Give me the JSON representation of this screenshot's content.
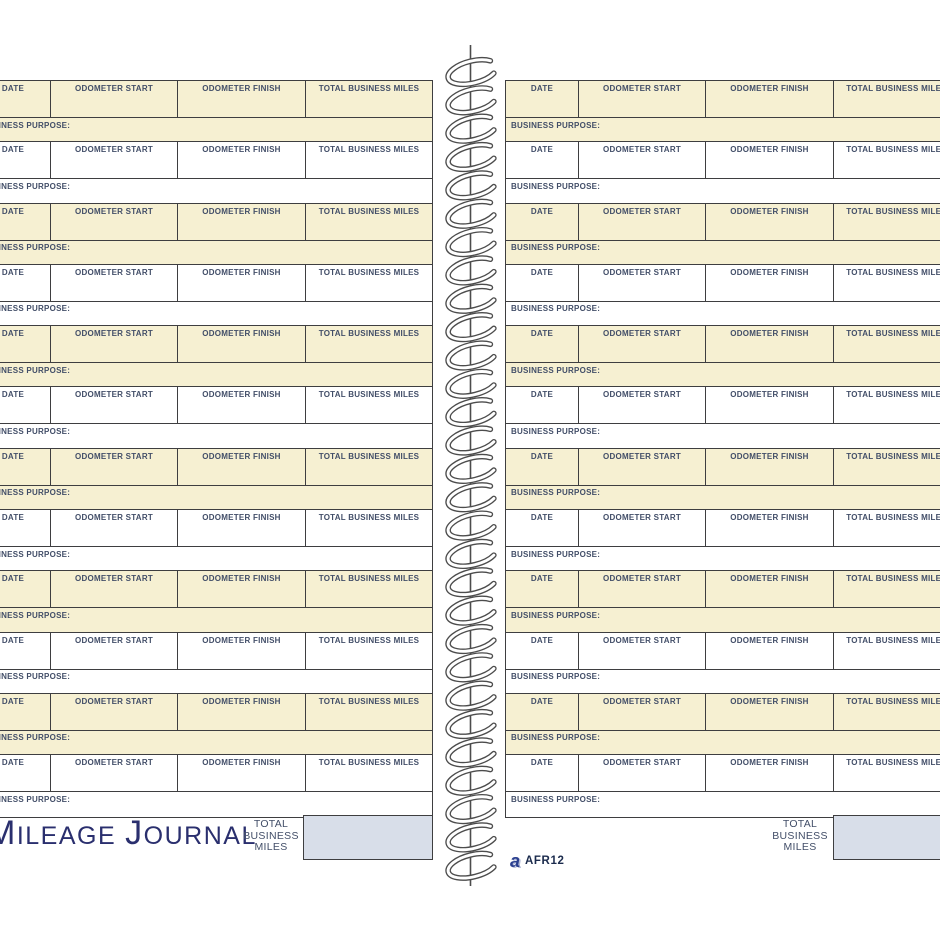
{
  "colors": {
    "cream_row": "#F6F0D2",
    "border": "#3E3E40",
    "header_text": "#424E68",
    "title_navy": "#2A2F6E",
    "total_box_fill": "#D8DEE9",
    "brand_navy": "#2A3F8F",
    "code_text": "#1B2B4D"
  },
  "table": {
    "headers": [
      "DATE",
      "ODOMETER START",
      "ODOMETER FINISH",
      "TOTAL BUSINESS MILES"
    ],
    "purpose_label": "BUSINESS PURPOSE:",
    "entries_per_page": 12,
    "pages": 2
  },
  "footer": {
    "title": {
      "initial1": "M",
      "rest1": "ILEAGE",
      "initial2": "J",
      "rest2": "OURNAL"
    },
    "total_lines": [
      "TOTAL",
      "BUSINESS",
      "MILES"
    ],
    "brand_letter": "a",
    "product_code": "AFR12"
  }
}
